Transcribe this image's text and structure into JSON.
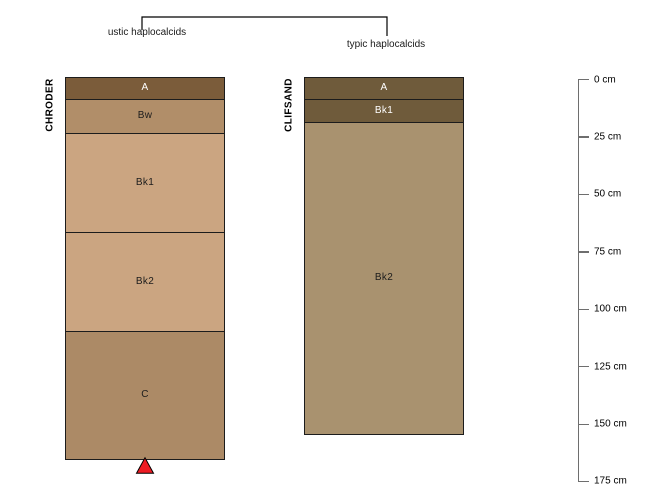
{
  "figure": {
    "background_color": "#ffffff",
    "dendrogram": {
      "line_color": "#000000",
      "left_group_label": "ustic haplocalcids",
      "right_group_label": "typic haplocalcids"
    },
    "truncation_marker": {
      "shape": "triangle-up",
      "fill_color": "#ED1C24",
      "border_color": "#000000"
    },
    "axis_line_color": "#6e6e6e",
    "horizon_border_color": "#1c1c1c"
  },
  "chart_data": {
    "type": "other",
    "subtype": "soil-profile-sketch",
    "title": "",
    "depth_axis": {
      "unit": "cm",
      "min": 0,
      "max": 175,
      "interval": 25,
      "ticks": [
        {
          "value": 0,
          "label": "0 cm"
        },
        {
          "value": 25,
          "label": "25 cm"
        },
        {
          "value": 50,
          "label": "50 cm"
        },
        {
          "value": 75,
          "label": "75 cm"
        },
        {
          "value": 100,
          "label": "100 cm"
        },
        {
          "value": 125,
          "label": "125 cm"
        },
        {
          "value": 150,
          "label": "150 cm"
        },
        {
          "value": 175,
          "label": "175 cm"
        }
      ]
    },
    "profiles": [
      {
        "id": "CHRODER",
        "group": "ustic haplocalcids",
        "truncated": true,
        "horizons": [
          {
            "name": "A",
            "top": 0,
            "bottom": 9,
            "color": "#7B5C3A",
            "label_color": "#FFFFFF"
          },
          {
            "name": "Bw",
            "top": 9,
            "bottom": 24,
            "color": "#B18E69",
            "label_color": "#1c1c1c"
          },
          {
            "name": "Bk1",
            "top": 24,
            "bottom": 67,
            "color": "#CBA581",
            "label_color": "#1c1c1c"
          },
          {
            "name": "Bk2",
            "top": 67,
            "bottom": 110,
            "color": "#CBA581",
            "label_color": "#1c1c1c"
          },
          {
            "name": "C",
            "top": 110,
            "bottom": 166,
            "color": "#AC8A66",
            "label_color": "#1c1c1c"
          }
        ]
      },
      {
        "id": "CLIFSAND",
        "group": "typic haplocalcids",
        "truncated": false,
        "horizons": [
          {
            "name": "A",
            "top": 0,
            "bottom": 9,
            "color": "#6F5B3B",
            "label_color": "#FFFFFF"
          },
          {
            "name": "Bk1",
            "top": 9,
            "bottom": 19,
            "color": "#6F5B3B",
            "label_color": "#FFFFFF"
          },
          {
            "name": "Bk2",
            "top": 19,
            "bottom": 155,
            "color": "#A9926F",
            "label_color": "#1c1c1c"
          }
        ]
      }
    ]
  }
}
